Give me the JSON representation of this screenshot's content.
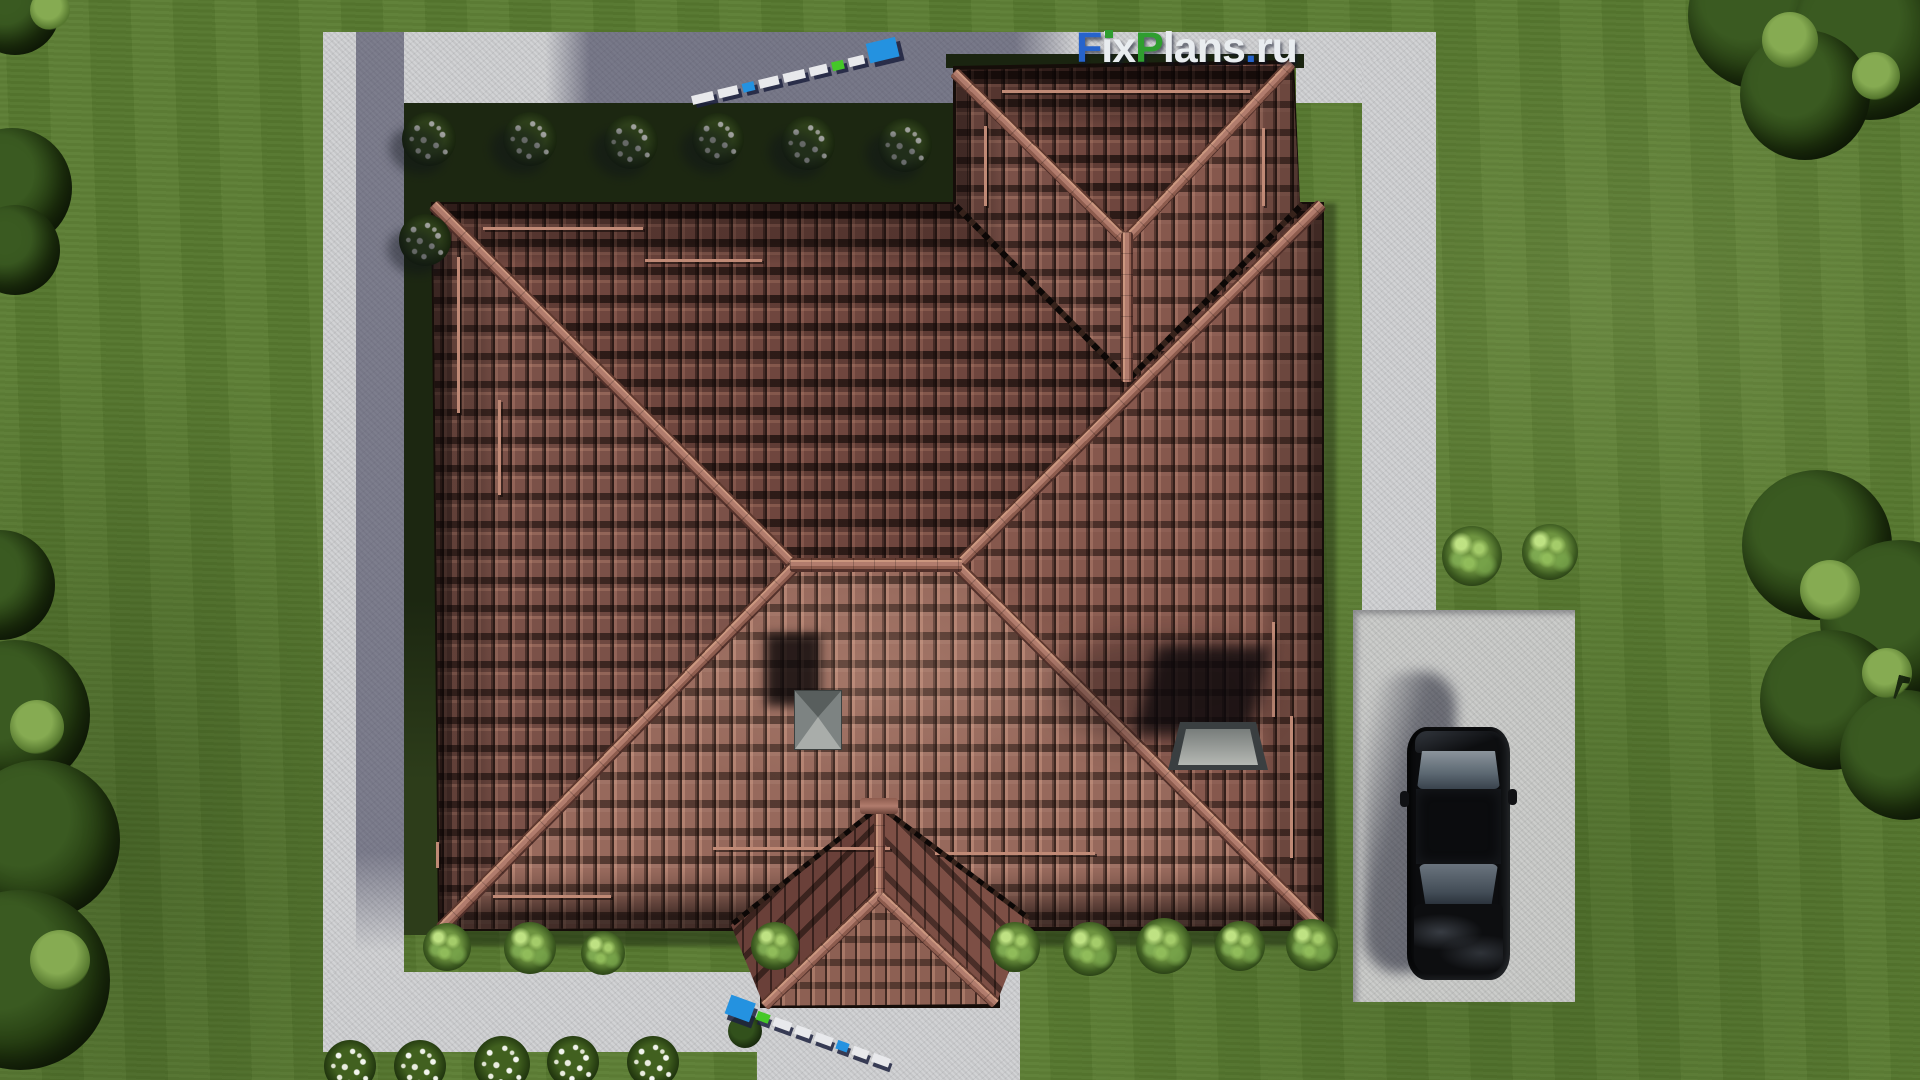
{
  "watermark": {
    "full_text": "FixPlans.ru",
    "part_f": "F",
    "part_ix": "ix",
    "part_p": "P",
    "part_lans": "lans",
    "part_dot": ".",
    "part_ru": "ru",
    "color_blue": "#2663cc",
    "color_green": "#2f9e2f",
    "color_white": "#e9edf0"
  },
  "scene": {
    "type": "3d-architectural-render-top-view",
    "subject": "bird's-eye view of hip-roof house with tiled roof, paths, driveway and lawn",
    "objects": [
      "main hip roof",
      "north-east annex roof",
      "south porch roof",
      "chimney cap",
      "roof hatch",
      "black sedan on driveway",
      "surveyor rulers",
      "white flowering shrubs",
      "green shrubs",
      "trees",
      "concrete paths",
      "lawn"
    ],
    "colors": {
      "grass": "#5a7c31",
      "grass_shadow": "#1c2711",
      "roof_tile": "#7b5148",
      "roof_tile_south": "#97695c",
      "ridge_cap": "#b17c6d",
      "path": "#d0d1d3",
      "path_shadow": "#55556e",
      "driveway": "#c9cac8",
      "car_body": "#0c0d0f",
      "ruler_blue": "#2492e0",
      "ruler_green": "#45c828"
    }
  }
}
